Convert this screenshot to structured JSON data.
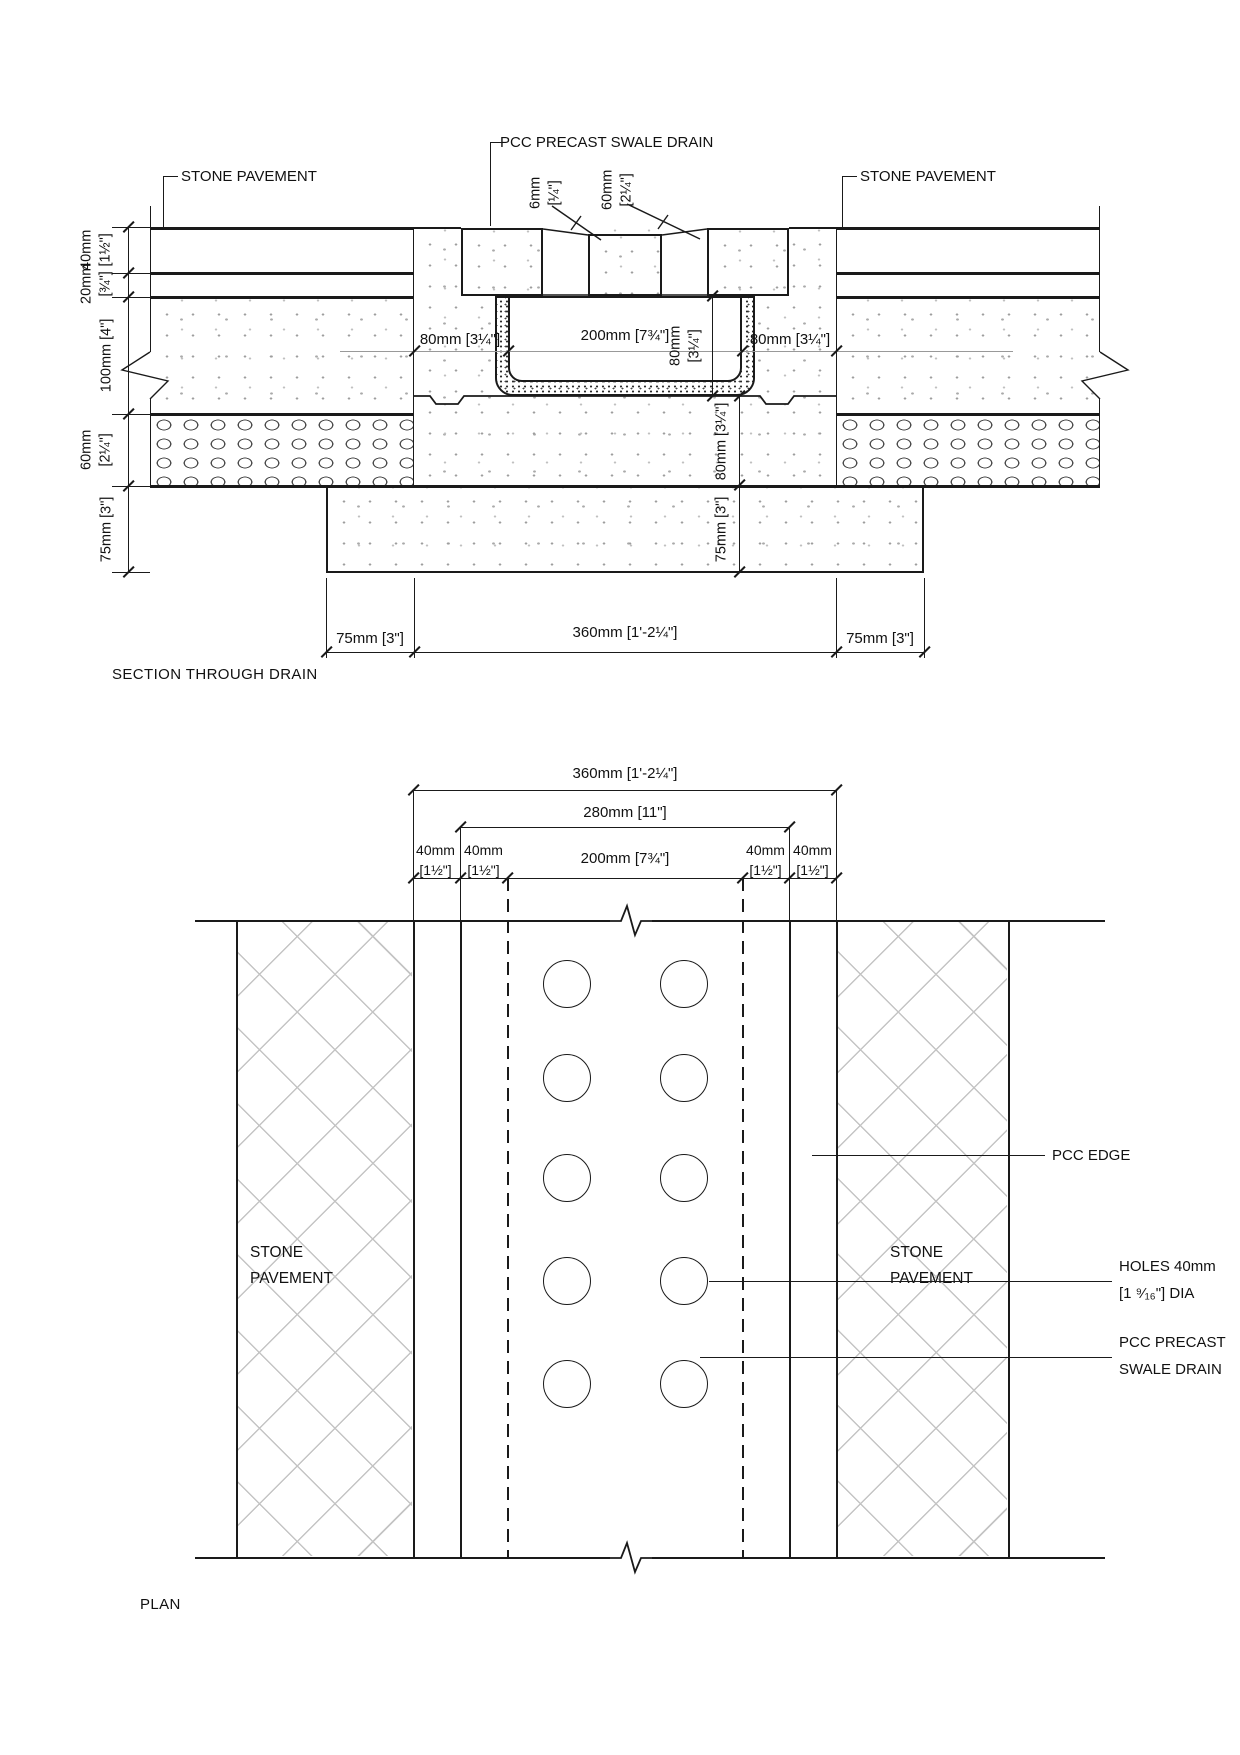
{
  "drawing": {
    "line_color": "#1a1a1a",
    "dim_line_color": "#999999",
    "section": {
      "title": "SECTION THROUGH DRAIN",
      "callouts": {
        "stone_pavement_left": "STONE PAVEMENT",
        "stone_pavement_right": "STONE PAVEMENT",
        "precast_drain": "PCC PRECAST SWALE DRAIN"
      },
      "left_dims": [
        {
          "mm": "40mm",
          "in": "[1½\"]"
        },
        {
          "mm": "20mm",
          "in": "[¾\"]"
        },
        {
          "mm": "100mm [4\"]",
          "in": ""
        },
        {
          "mm": "60mm",
          "in": "[2¼\"]"
        },
        {
          "mm": "75mm [3\"]",
          "in": ""
        }
      ],
      "top_dims": [
        {
          "mm": "6mm",
          "in": "[¼\"]"
        },
        {
          "mm": "60mm",
          "in": "[2¼\"]"
        }
      ],
      "channel_dims": {
        "left_wall": "80mm [3¼\"]",
        "inner_width": "200mm [7¾\"]",
        "right_wall": "80mm [3¼\"]",
        "rim_depth_mm": "80mm",
        "rim_depth_in": "[3¼\"]"
      },
      "under_dims": [
        "80mm [3¼\"]",
        "75mm [3\"]"
      ],
      "bottom_dims": [
        "75mm [3\"]",
        "360mm [1'-2¼\"]",
        "75mm [3\"]"
      ]
    },
    "plan": {
      "title": "PLAN",
      "width_dims": {
        "overall": "360mm [1'-2¼\"]",
        "precast": "280mm [11\"]",
        "channel": "200mm [7¾\"]",
        "edges": [
          {
            "mm": "40mm",
            "in": "[1½\"]"
          },
          {
            "mm": "40mm",
            "in": "[1½\"]"
          },
          {
            "mm": "40mm",
            "in": "[1½\"]"
          },
          {
            "mm": "40mm",
            "in": "[1½\"]"
          }
        ]
      },
      "labels": {
        "stone_pavement_left_1": "STONE",
        "stone_pavement_left_2": "PAVEMENT",
        "stone_pavement_right_1": "STONE",
        "stone_pavement_right_2": "PAVEMENT",
        "pcc_edge": "PCC EDGE",
        "holes_1": "HOLES 40mm",
        "holes_2": "[1 ⁹⁄₁₆\"] DIA",
        "precast_1": "PCC PRECAST",
        "precast_2": "SWALE DRAIN"
      },
      "holes": {
        "rows": 5,
        "cols": 2
      }
    }
  }
}
